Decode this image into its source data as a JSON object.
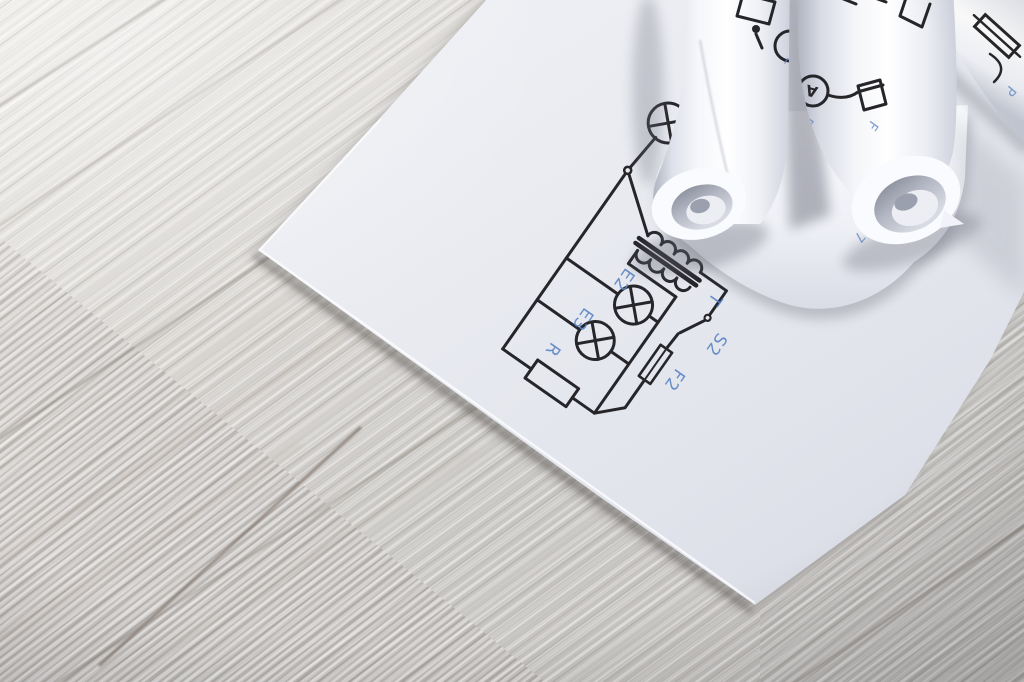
{
  "scene": {
    "description": "White rolled-up wiring diagram blueprints lying on an electrical schematic sheet on a whitewashed wooden table"
  },
  "colors": {
    "schematic_line": "#26262a",
    "label_blue": "#5b84c4",
    "paper": "#e9ebf1",
    "wood": "#cfccc8"
  },
  "schematic": {
    "labels": {
      "transformer": "T",
      "switch": "S2",
      "fuse": "F2",
      "lamp_e2": "E2",
      "lamp_e3": "E3",
      "resistor": "R"
    }
  },
  "rolls": {
    "roll1": {
      "label_l": "L"
    },
    "roll2": {
      "ammeter": "A",
      "label_p": "P",
      "label_f": "F"
    },
    "roll3": {
      "label_p": "P"
    },
    "curl_sheet": {
      "label_7": "7"
    }
  }
}
